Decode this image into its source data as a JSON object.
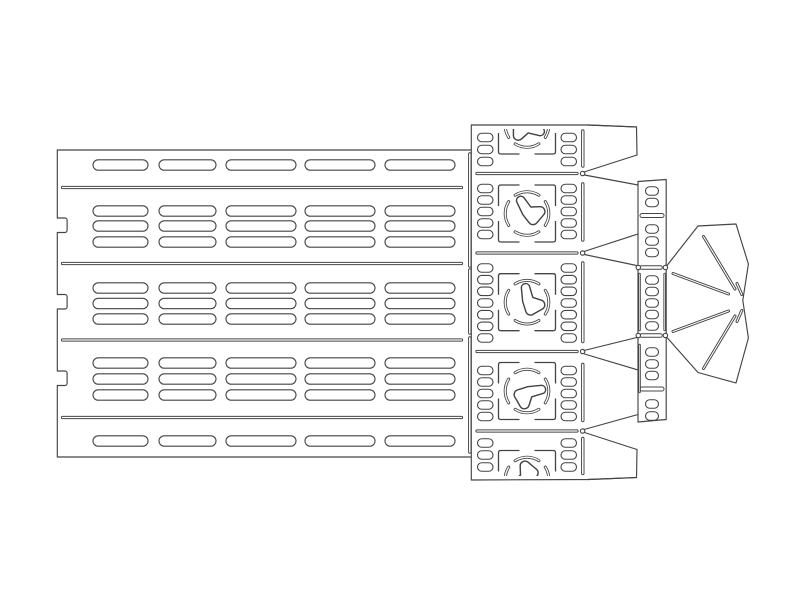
{
  "meta": {
    "description": "laser-cut vector template drawing",
    "background": "#ffffff",
    "stroke": "#444444",
    "canvas": {
      "width": 800,
      "height": 606
    }
  },
  "left_panel": {
    "outline_path": "M 471.3,150 L 57.3,150 L 57.3,218 L 64.9,218 A 2.2,2.2 0 0 1 67.1,220.2 L 67.1,230.3 A 2.2,2.2 0 0 1 64.9,232.5 L 57.3,232.5 L 57.3,294.5 L 64.9,294.5 A 2.2,2.2 0 0 1 67.1,296.7 L 67.1,306.8 A 2.2,2.2 0 0 1 64.9,309 L 57.3,309 L 57.3,371 L 64.9,371 A 2.2,2.2 0 0 1 67.1,373.2 L 67.1,383.3 A 2.2,2.2 0 0 1 64.9,385.5 L 57.3,385.5 L 57.3,457 L 471.3,457",
    "long_slits": {
      "x1": 62.5,
      "x2": 461.5,
      "w": 3.2,
      "ys": [
        187.5,
        263.5,
        340,
        417.5
      ]
    },
    "slot_cols": [
      {
        "x": 93,
        "w": 55
      },
      {
        "x": 159,
        "w": 57
      },
      {
        "x": 226,
        "w": 70
      },
      {
        "x": 305,
        "w": 70
      },
      {
        "x": 385,
        "w": 70
      }
    ],
    "slot_h": 10.4,
    "slot_rows": [
      165,
      211,
      226,
      242,
      288,
      303.5,
      319,
      363,
      379,
      395,
      441
    ]
  },
  "junction_slits": {
    "cx": 469.8,
    "w": 3.4,
    "segs": [
      [
        154,
        266
      ],
      [
        270,
        333
      ],
      [
        338,
        452
      ]
    ]
  },
  "center_strip": {
    "left_x": 471.3,
    "top": 125,
    "bottom": 480,
    "top_edge": [
      [
        471.3,
        125
      ],
      [
        588,
        125
      ],
      [
        636.5,
        127
      ]
    ],
    "bottom_edge": [
      [
        471.3,
        480
      ],
      [
        588,
        479.5
      ],
      [
        636.5,
        477.5
      ]
    ],
    "h_slits": {
      "x1": 477,
      "x2": 577,
      "w": 3.2,
      "ys": [
        173.5,
        253,
        351.5,
        431
      ]
    },
    "joint_circles": {
      "cx": 582.6,
      "r": 2.2,
      "ys": [
        173.5,
        253,
        351.5,
        431
      ]
    },
    "v_slits": {
      "cx": 582.8,
      "w": 3.4,
      "segs": [
        [
          131,
          166
        ],
        [
          184,
          240
        ],
        [
          263,
          341.5
        ],
        [
          364.5,
          420.5
        ],
        [
          438.5,
          473.5
        ]
      ]
    },
    "slot_cols": [
      {
        "x": 477.5,
        "w": 15.5
      },
      {
        "x": 561,
        "w": 15.5
      }
    ],
    "slot_h": 8.5,
    "sections": [
      {
        "cy": 125.5,
        "rot": 25,
        "rows": [
          137.5,
          149.5,
          161.5
        ]
      },
      {
        "cy": 213.5,
        "rot": -115,
        "rows": [
          188.5,
          200,
          211.5,
          223,
          234.5
        ]
      },
      {
        "cy": 302.2,
        "rot": -95,
        "rows": [
          268,
          279.7,
          291.3,
          303,
          314.7,
          326.3,
          338
        ]
      },
      {
        "cy": 391,
        "rot": -5,
        "rows": [
          370.5,
          382,
          393.5,
          405,
          416.5
        ]
      },
      {
        "cy": 479,
        "rot": 155,
        "rows": [
          443,
          455,
          467
        ]
      }
    ],
    "pattern": {
      "cx": 527,
      "square_half": 28.5,
      "gap_half": 7.5,
      "corner_r": 2.2,
      "circle_r": 21.8,
      "arcs": [
        [
          57,
          123
        ],
        [
          147,
          213
        ],
        [
          237,
          303
        ],
        [
          327,
          393
        ]
      ],
      "blob_path": "M 12,-3.5 A 3.4,3.4 0 0 1 12.6,3.1 L 3.4,5 L 0.6,11.6 A 3.9,3.9 0 0 1 -6.4,12 L -9.8,4.6 A 4,4 0 0 1 -7.2,-1.6 L 0.8,-3.4 Z",
      "blob_scale": 1.25,
      "clip": {
        "x": 471.5,
        "y1": 129,
        "x2": 588.5,
        "y2": 476
      }
    }
  },
  "right_strip": {
    "outline": [
      [
        638,
        181.5
      ],
      [
        666.2,
        179.5
      ],
      [
        666.2,
        419.5
      ],
      [
        638,
        422
      ]
    ],
    "slots": {
      "cx": 652,
      "w": 13,
      "h": 8.5,
      "rows": [
        191,
        202.5,
        229,
        241,
        252.5,
        280,
        291.5,
        303,
        314.5,
        326,
        352,
        364,
        375.5,
        404,
        416
      ]
    },
    "bars": {
      "x1": 642,
      "x2": 662,
      "w": 5,
      "ys": [
        215.5,
        389
      ]
    },
    "waist_bars": {
      "x1": 641.5,
      "x2": 660.5,
      "w": 4.5,
      "ys": [
        267.5,
        335.5
      ]
    },
    "waist_circles": {
      "lx": 638.3,
      "rx": 665.4,
      "r": 2.2,
      "ys": [
        267.5,
        335.5
      ]
    },
    "edge_slits": [
      {
        "cx": 639.6,
        "w": 2.4,
        "segs": [
          [
            274,
            330
          ],
          [
            345,
            392
          ]
        ]
      },
      {
        "cx": 664.6,
        "w": 2.4,
        "segs": [
          [
            274,
            330
          ]
        ]
      }
    ]
  },
  "connectors": [
    [
      588,
      125,
      636.5,
      127
    ],
    [
      636.5,
      127,
      637,
      155
    ],
    [
      637,
      155,
      584,
      172
    ],
    [
      584.5,
      175,
      638,
      185
    ],
    [
      584,
      251.5,
      638,
      234
    ],
    [
      584.5,
      254.5,
      637.9,
      265.8
    ],
    [
      584,
      350.5,
      637.9,
      337.2
    ],
    [
      584.5,
      354,
      638,
      370
    ],
    [
      584,
      429.5,
      638,
      414.5
    ],
    [
      584.5,
      432.5,
      637,
      449.5
    ],
    [
      637,
      449.5,
      636.5,
      477.5
    ],
    [
      588,
      479.5,
      636.5,
      477.5
    ]
  ],
  "fan": {
    "outline": [
      [
        667,
        265.5
      ],
      [
        698,
        226
      ],
      [
        736,
        224
      ],
      [
        748.4,
        264
      ],
      [
        742.8,
        300.3
      ],
      [
        748.4,
        338
      ],
      [
        736,
        383
      ],
      [
        698,
        372.5
      ],
      [
        667,
        337.5
      ]
    ],
    "slit_w": 3,
    "slits": [
      [
        703.5,
        236.5,
        735,
        289
      ],
      [
        673,
        273.5,
        728.5,
        294
      ],
      [
        673,
        331.5,
        728.5,
        311
      ],
      [
        703.5,
        368.5,
        735,
        316
      ],
      [
        737,
        283.5,
        741.8,
        294.5
      ],
      [
        737,
        321.5,
        741.8,
        310.5
      ]
    ]
  }
}
